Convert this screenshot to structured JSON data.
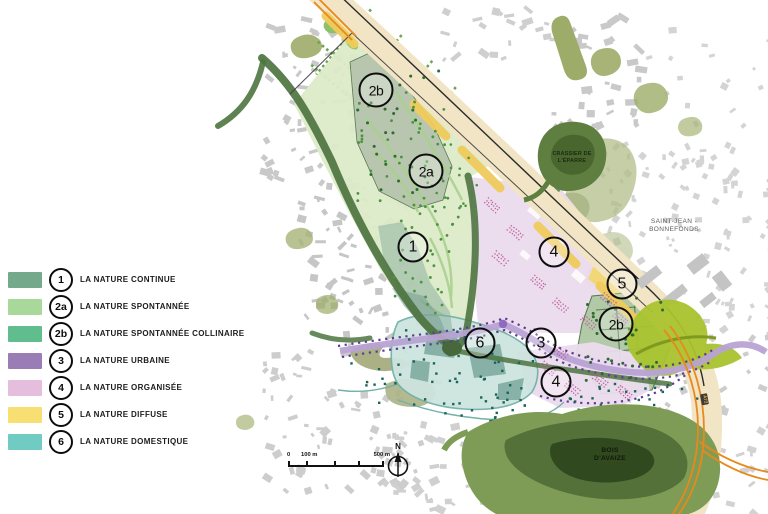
{
  "legend": {
    "items": [
      {
        "id": "1",
        "label": "LA NATURE CONTINUE",
        "color": "#74A98C"
      },
      {
        "id": "2a",
        "label": "LA NATURE SPONTANNÉE",
        "color": "#A9D89B"
      },
      {
        "id": "2b",
        "label": "LA NATURE SPONTANNÉE COLLINAIRE",
        "color": "#60BE8E"
      },
      {
        "id": "3",
        "label": "LA NATURE URBAINE",
        "color": "#9B7DB6"
      },
      {
        "id": "4",
        "label": "LA NATURE ORGANISÉE",
        "color": "#E5BDDD"
      },
      {
        "id": "5",
        "label": "LA NATURE DIFFUSE",
        "color": "#F8DF71"
      },
      {
        "id": "6",
        "label": "LA NATURE DOMESTIQUE",
        "color": "#70CBC3"
      }
    ]
  },
  "map": {
    "zone_labels": [
      {
        "text": "2b"
      },
      {
        "text": "2a"
      },
      {
        "text": "1"
      },
      {
        "text": "4"
      },
      {
        "text": "5"
      },
      {
        "text": "2b"
      },
      {
        "text": "6"
      },
      {
        "text": "3"
      },
      {
        "text": "4"
      }
    ],
    "place_labels": {
      "saint_jean_line1": "SAINT-JEAN -",
      "saint_jean_line2": "BONNEFONDS",
      "crassier_line1": "CRASSIER DE",
      "crassier_line2": "L'ÉPARRE",
      "bois_line1": "BOIS",
      "bois_line2": "D'AVAIZE",
      "road_shield": "A72"
    },
    "scale": {
      "start": "0",
      "mid": "100 m",
      "end": "500 m"
    },
    "north": "N"
  }
}
